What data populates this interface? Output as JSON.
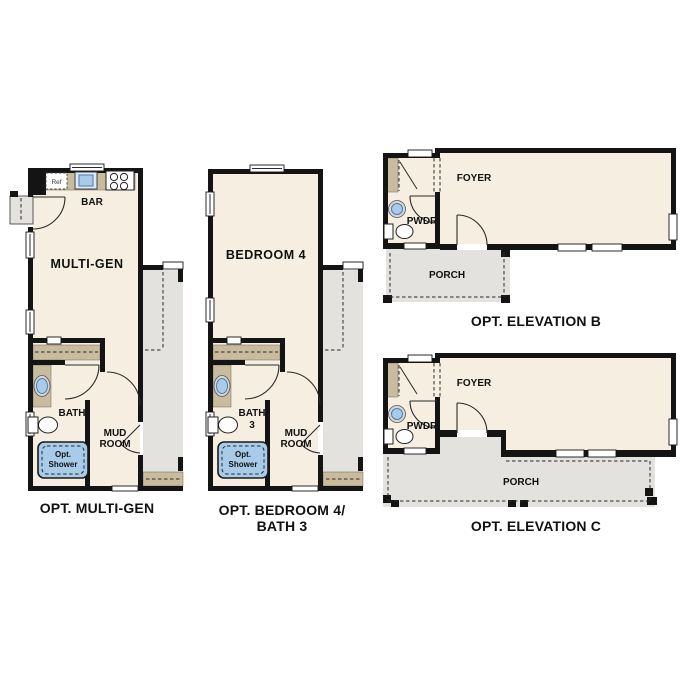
{
  "colors": {
    "wall": "#141414",
    "floor": "#f6efe1",
    "counter": "#c9bb9e",
    "porch_gray": "#e3e2de",
    "fixture_blue": "#a8cbe9",
    "fixture_ring": "#4f7cab",
    "fixture_gray": "#d6d6d6",
    "text": "#111111",
    "background": "#ffffff"
  },
  "plans": {
    "multi_gen": {
      "caption": "OPT. MULTI-GEN",
      "labels": {
        "ref": "Ref",
        "bar": "BAR",
        "room": "MULTI-GEN",
        "bath": "BATH",
        "mud_line1": "MUD",
        "mud_line2": "ROOM",
        "shower_line1": "Opt.",
        "shower_line2": "Shower"
      }
    },
    "bedroom4": {
      "caption_line1": "OPT. BEDROOM 4/",
      "caption_line2": "BATH 3",
      "labels": {
        "room": "BEDROOM 4",
        "bath_line1": "BATH",
        "bath_line2": "3",
        "mud_line1": "MUD",
        "mud_line2": "ROOM",
        "shower_line1": "Opt.",
        "shower_line2": "Shower"
      }
    },
    "elevation_b": {
      "caption": "OPT. ELEVATION B",
      "labels": {
        "foyer": "FOYER",
        "pwdr": "PWDR",
        "porch": "PORCH"
      }
    },
    "elevation_c": {
      "caption": "OPT. ELEVATION C",
      "labels": {
        "foyer": "FOYER",
        "pwdr": "PWDR",
        "porch": "PORCH"
      }
    }
  }
}
